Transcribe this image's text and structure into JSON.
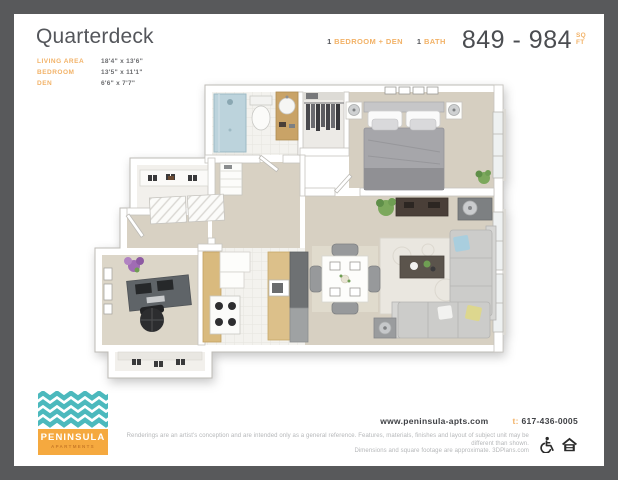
{
  "header": {
    "title": "Quarterdeck",
    "specs": [
      {
        "label": "LIVING AREA",
        "value": "18'4\" x 13'6\""
      },
      {
        "label": "BEDROOM",
        "value": "13'5\" x 11'1\""
      },
      {
        "label": "DEN",
        "value": "6'6\" x 7'7\""
      }
    ],
    "summary": {
      "bed_count": "1",
      "bed_label": "BEDROOM + DEN",
      "bath_count": "1",
      "bath_label": "BATH",
      "sqft_range": "849 - 984",
      "sqft_unit_top": "SQ",
      "sqft_unit_bottom": "FT"
    }
  },
  "floorplan": {
    "rooms": [
      "bathroom",
      "bedroom",
      "bedroom-closet",
      "hallway",
      "entry",
      "shoe-closet",
      "den",
      "den-closet",
      "kitchen",
      "living-dining-area"
    ],
    "floor_color": "#d7d0c2"
  },
  "footer": {
    "logo": {
      "brand": "PENINSULA",
      "brand_sub": "APARTMENTS"
    },
    "website": "www.peninsula-apts.com",
    "phone_prefix": "t:",
    "phone": "617-436-0005",
    "disclaimer_line1": "Renderings are an artist's conception and are intended only as a general reference. Features, materials, finishes and layout of subject unit may be different than shown.",
    "disclaimer_line2": "Dimensions and square footage are approximate. 3DPlans.com",
    "icons": [
      "wheelchair-accessible-icon",
      "equal-housing-opportunity-icon"
    ]
  },
  "colors": {
    "frame": "#58595b",
    "page": "#ffffff",
    "accent_gold": "#f2b267",
    "title_gray": "#54565b",
    "value_gray": "#6a6b6e",
    "logo_teal": "#4cb9bd",
    "logo_orange": "#f5a93f",
    "floor_beige": "#d7d0c2",
    "disclaimer_gray": "#b5b7b9"
  }
}
